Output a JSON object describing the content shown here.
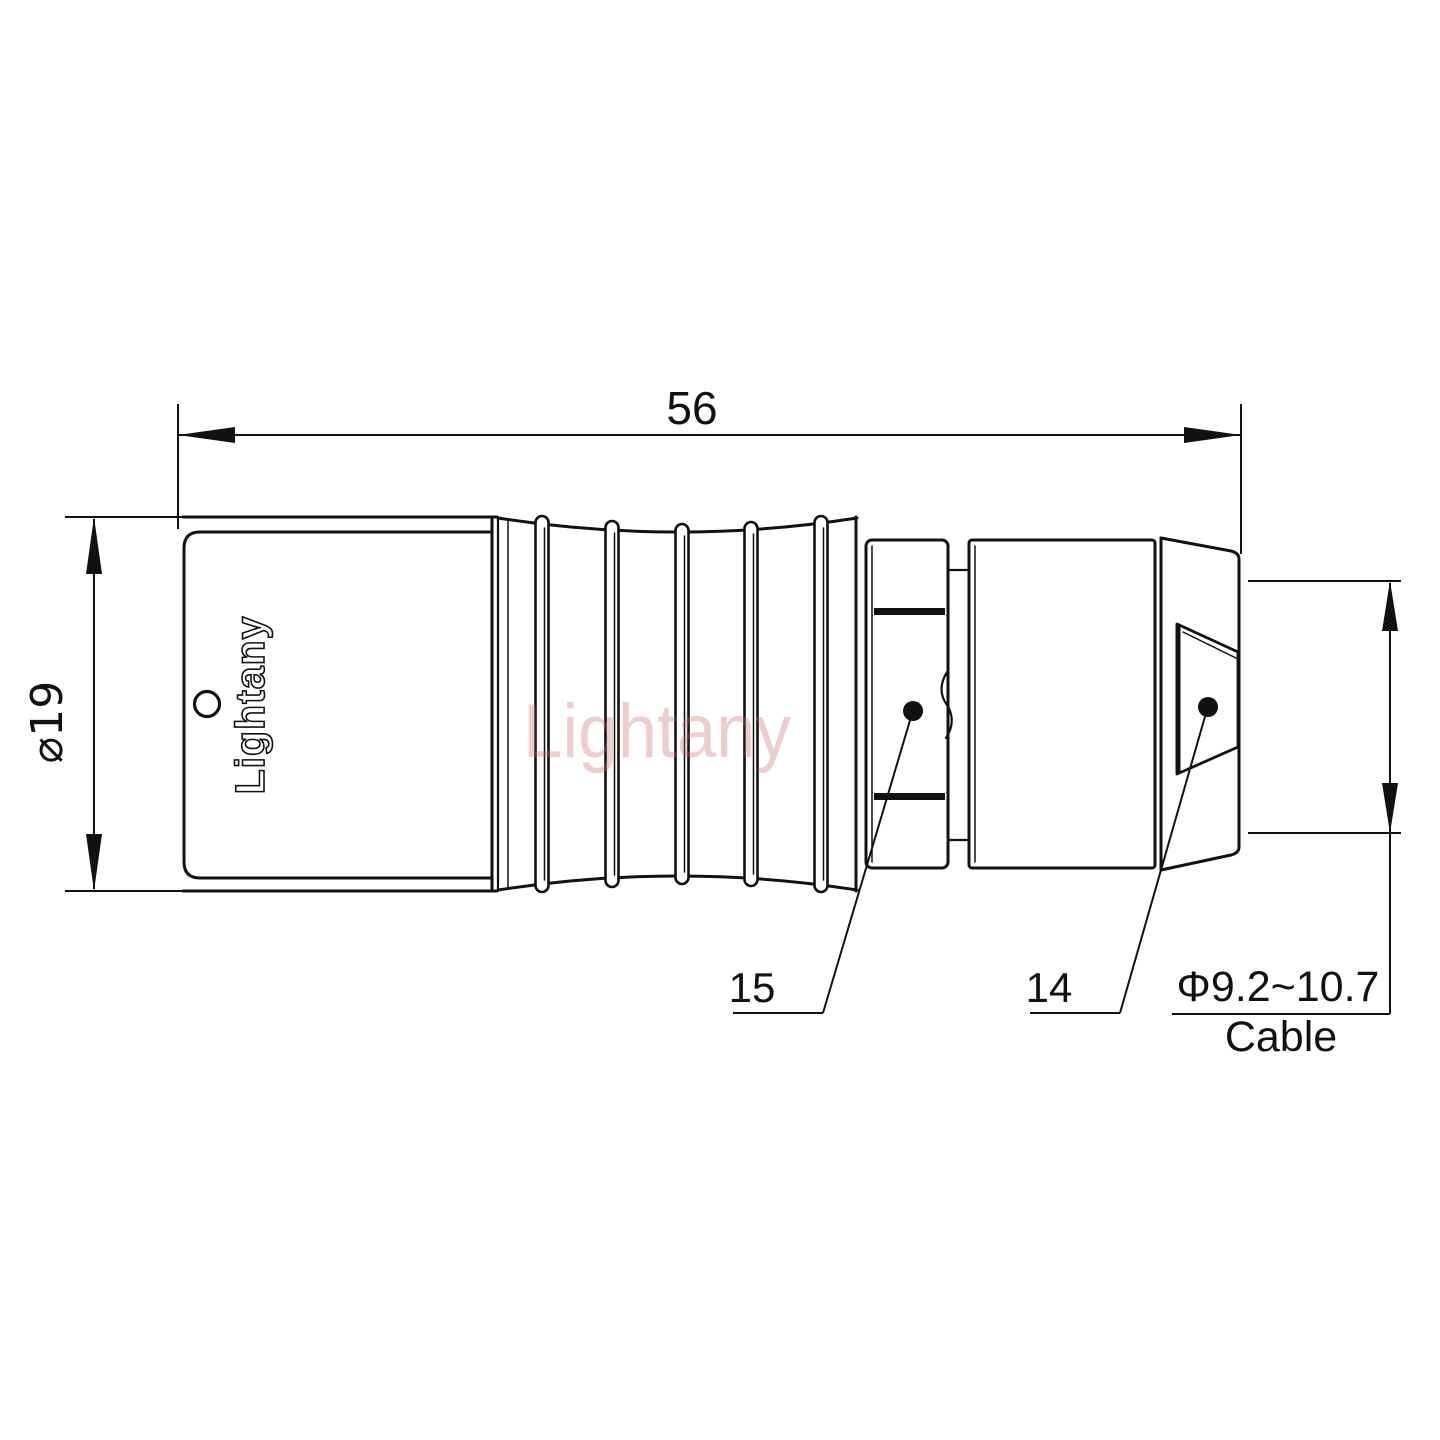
{
  "drawing": {
    "overall_length": "56",
    "body_diameter": "⌀19",
    "boot_part_number": "15",
    "nut_part_number": "14",
    "cable_diameter_range": "Φ9.2~10.7",
    "cable_label": "Cable",
    "body_logo": "Lightany",
    "watermark": "Lightany"
  },
  "colors": {
    "line": "#111111",
    "background": "#ffffff",
    "watermark": "#c96a6a"
  }
}
